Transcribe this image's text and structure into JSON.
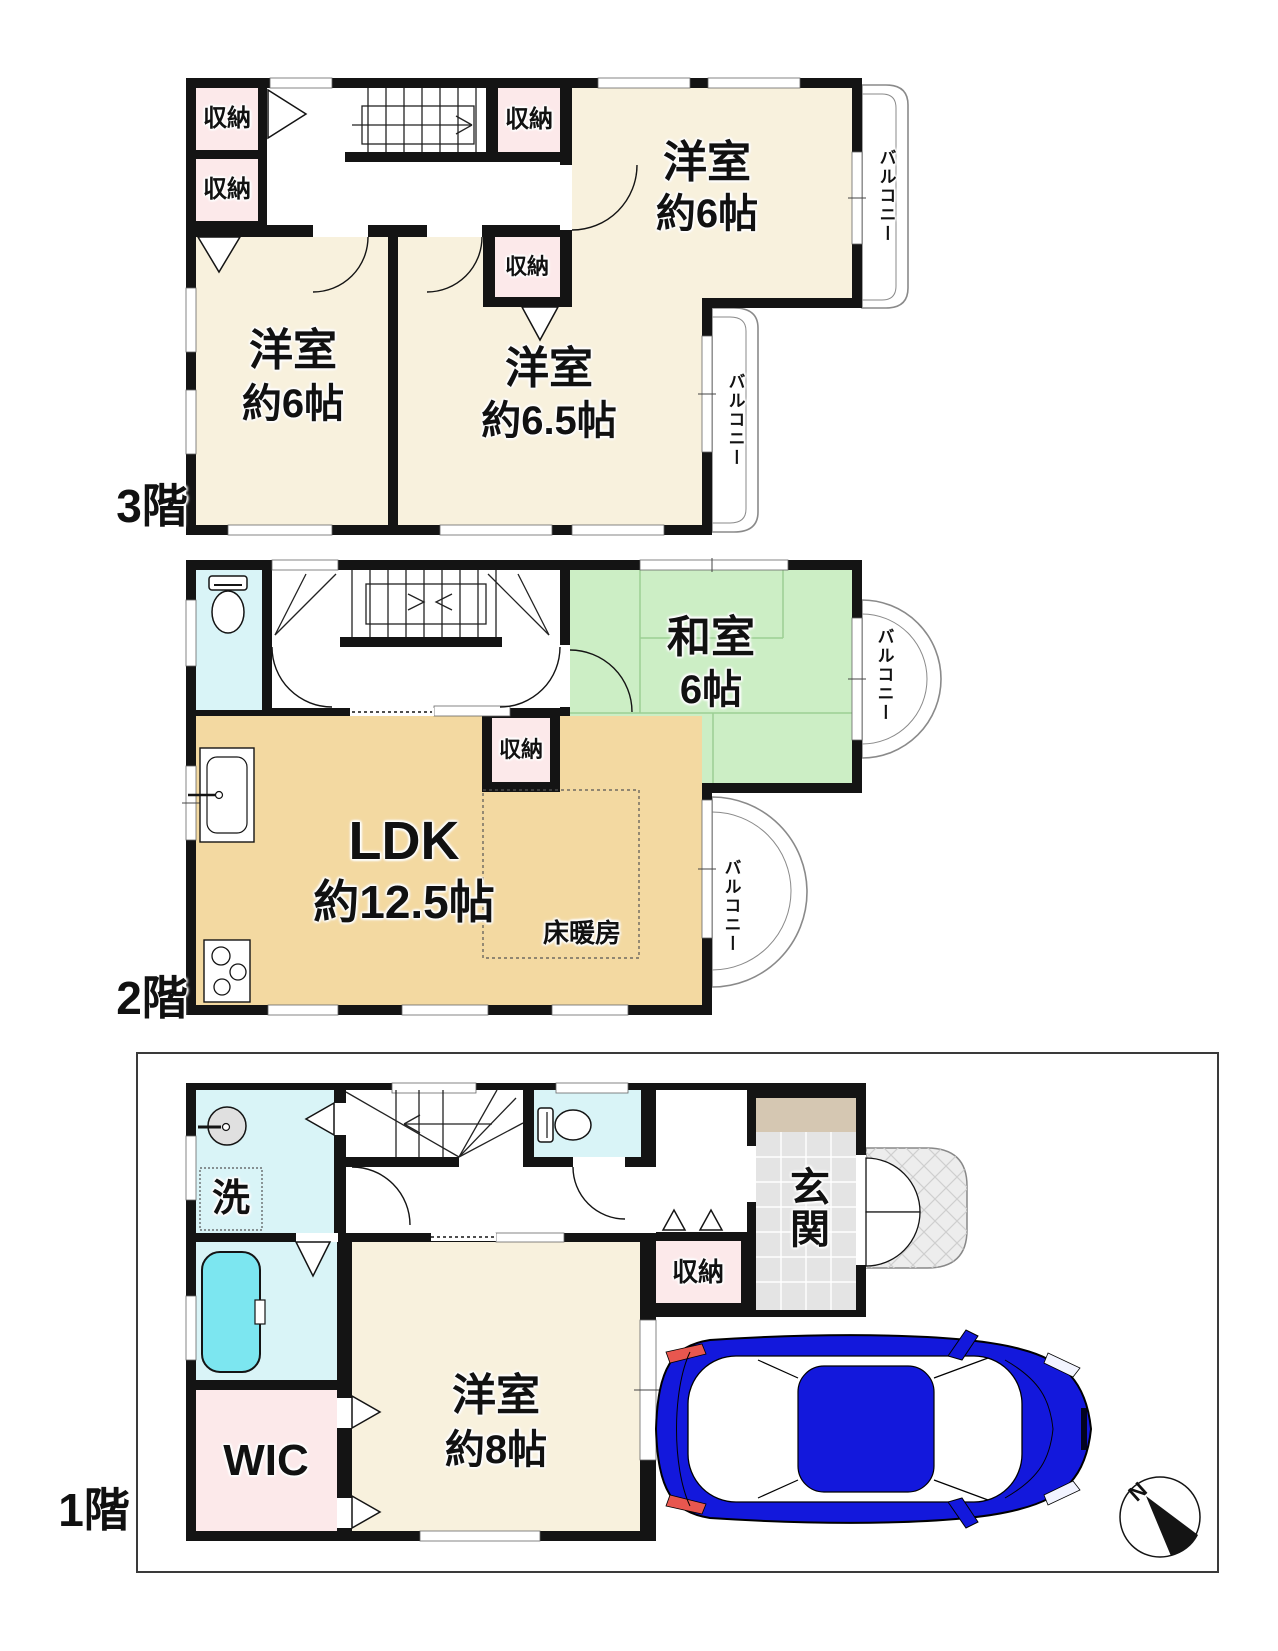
{
  "colors": {
    "wall": "#141414",
    "room_cream": "#f8f1dd",
    "storage_pink": "#fce9ea",
    "tatami_green": "#cceec5",
    "tatami_line": "#9ccf93",
    "ldk_tan": "#f3d9a1",
    "water_cyan": "#d9f4f7",
    "tub_cyan": "#7ce6f0",
    "entry_tan": "#d5c7b2",
    "tile_gray": "#e4e4e4",
    "porch_gray": "#ededed",
    "car_blue": "#1318dc",
    "taillight_red": "#e8574f",
    "balcony_line": "#8a8a8a"
  },
  "floor3": {
    "floor_label": "3階",
    "closet_a": "収納",
    "closet_b": "収納",
    "closet_c": "収納",
    "closet_d": "収納",
    "room_top_name": "洋室",
    "room_top_area": "約6帖",
    "room_left_name": "洋室",
    "room_left_area": "約6帖",
    "room_mid_name": "洋室",
    "room_mid_area": "約6.5帖",
    "balcony_top": "バルコニー",
    "balcony_mid": "バルコニー"
  },
  "floor2": {
    "floor_label": "2階",
    "washitsu_name": "和室",
    "washitsu_area": "6帖",
    "closet": "収納",
    "ldk_name": "LDK",
    "ldk_area": "約12.5帖",
    "floor_heating": "床暖房",
    "balcony_upper": "バルコニー",
    "balcony_lower": "バルコニー"
  },
  "floor1": {
    "floor_label": "1階",
    "laundry": "洗",
    "entrance": "玄関",
    "closet": "収納",
    "wic": "WIC",
    "room_name": "洋室",
    "room_area": "約8帖"
  },
  "compass": {
    "north_label": "N"
  }
}
